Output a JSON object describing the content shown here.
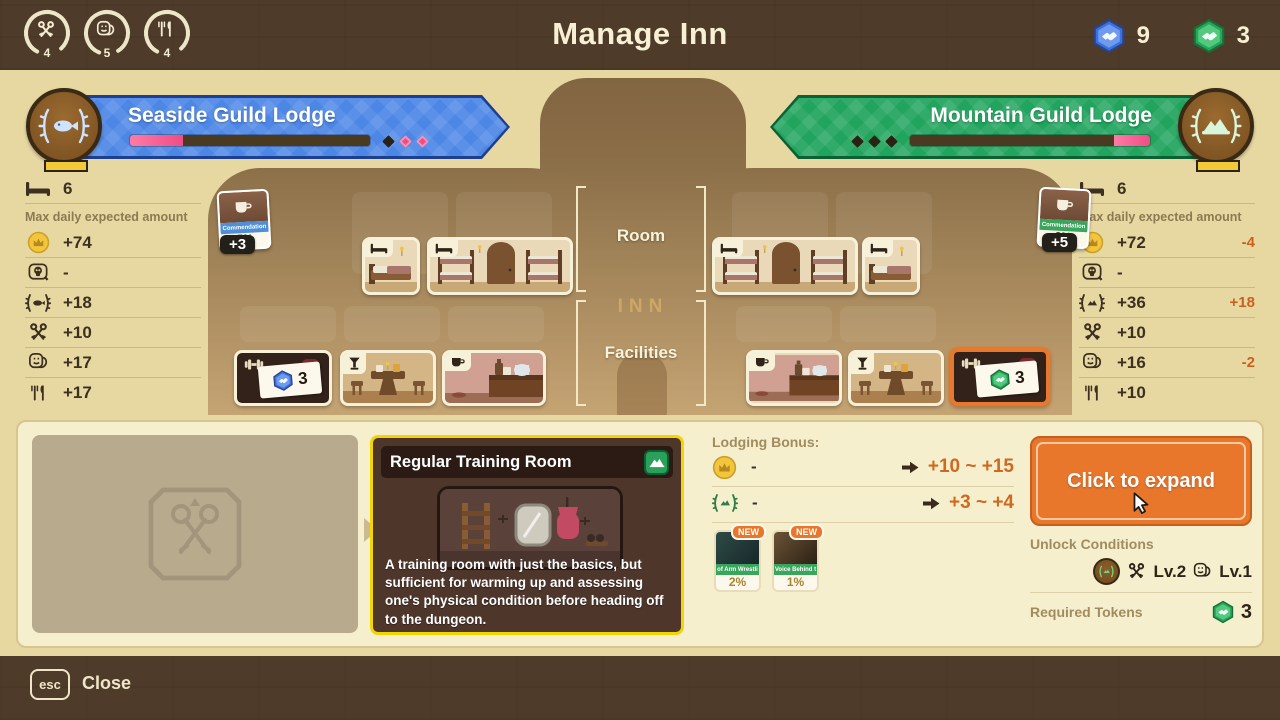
{
  "colors": {
    "bar_brown": "#4f3b2a",
    "wall_tan": "#e7d8a2",
    "accent_orange": "#e8772c",
    "seaside_blue": "#4d87e6",
    "mountain_green": "#21a45d",
    "blue_token": "#3f6fd8",
    "green_token": "#27a65a",
    "delta_orange": "#cd5f1e",
    "detail_card_border": "#f4d503"
  },
  "header": {
    "title": "Manage Inn",
    "gauges": [
      {
        "icon": "crossed-keys-icon",
        "value": "4"
      },
      {
        "icon": "masks-icon",
        "value": "5"
      },
      {
        "icon": "utensils-icon",
        "value": "4"
      }
    ],
    "currencies": [
      {
        "icon": "blue-token-icon",
        "value": "9"
      },
      {
        "icon": "green-token-icon",
        "value": "3"
      }
    ]
  },
  "lodges": {
    "left": {
      "name": "Seaside Guild Lodge",
      "progress_pct": 22,
      "diamonds": [
        "dark",
        "pink",
        "pink"
      ],
      "emblem": "fish-laurel-icon"
    },
    "right": {
      "name": "Mountain Guild Lodge",
      "progress_pct": 15,
      "diamonds": [
        "dark",
        "dark",
        "dark"
      ],
      "emblem": "mountain-laurel-icon"
    }
  },
  "left_stats": {
    "beds": "6",
    "header": "Max daily expected amount",
    "rows": [
      {
        "icon": "crown-coin-icon",
        "value": "+74",
        "delta": ""
      },
      {
        "icon": "skull-icon",
        "value": "-",
        "delta": ""
      },
      {
        "icon": "laurel-fish-icon",
        "value": "+18",
        "delta": ""
      },
      {
        "icon": "crossed-keys-icon",
        "value": "+10",
        "delta": ""
      },
      {
        "icon": "masks-icon",
        "value": "+17",
        "delta": ""
      },
      {
        "icon": "utensils-icon",
        "value": "+17",
        "delta": ""
      }
    ]
  },
  "right_stats": {
    "beds": "6",
    "header": "Max daily expected amount",
    "rows": [
      {
        "icon": "crown-coin-icon",
        "value": "+72",
        "delta": "-4"
      },
      {
        "icon": "skull-icon",
        "value": "-",
        "delta": ""
      },
      {
        "icon": "laurel-mtn-icon",
        "value": "+36",
        "delta": "+18"
      },
      {
        "icon": "crossed-keys-icon",
        "value": "+10",
        "delta": ""
      },
      {
        "icon": "masks-icon",
        "value": "+16",
        "delta": "-2"
      },
      {
        "icon": "utensils-icon",
        "value": "+10",
        "delta": ""
      }
    ]
  },
  "map": {
    "room_label": "Room",
    "facilities_label": "Facilities",
    "inn_sign": "INN",
    "left_commendation": {
      "label": "Commendation",
      "percent": "5%",
      "badge": "+3"
    },
    "right_commendation": {
      "label": "Commendation",
      "percent": "3%",
      "badge": "+5"
    },
    "left_locked": {
      "icon": "dumbbell-icon",
      "token": "blue-token-icon",
      "count": "3"
    },
    "right_locked": {
      "icon": "dumbbell-icon",
      "token": "green-token-icon",
      "count": "3"
    }
  },
  "detail": {
    "card": {
      "title": "Regular Training Room",
      "badge_icon": "mountain-badge-icon",
      "description": "A training room with just the basics, but sufficient for warming up and assessing one's physical condition before heading off to the dungeon."
    },
    "lodging": {
      "label": "Lodging Bonus:",
      "rows": [
        {
          "icon": "crown-coin-icon",
          "current": "-",
          "value": "+10 ~ +15"
        },
        {
          "icon": "laurel-mtn-icon",
          "current": "-",
          "value": "+3 ~ +4"
        }
      ],
      "cards": [
        {
          "badge": "NEW",
          "label": "of Arm Wrestli",
          "percent": "2%"
        },
        {
          "badge": "NEW",
          "label": "Voice Behind t",
          "percent": "1%"
        }
      ]
    },
    "expand_label": "Click to expand",
    "unlock": {
      "label": "Unlock Conditions",
      "key_level": "Lv.2",
      "mask_level": "Lv.1"
    },
    "tokens": {
      "label": "Required Tokens",
      "value": "3"
    }
  },
  "footer": {
    "esc_label": "esc",
    "close_label": "Close"
  }
}
